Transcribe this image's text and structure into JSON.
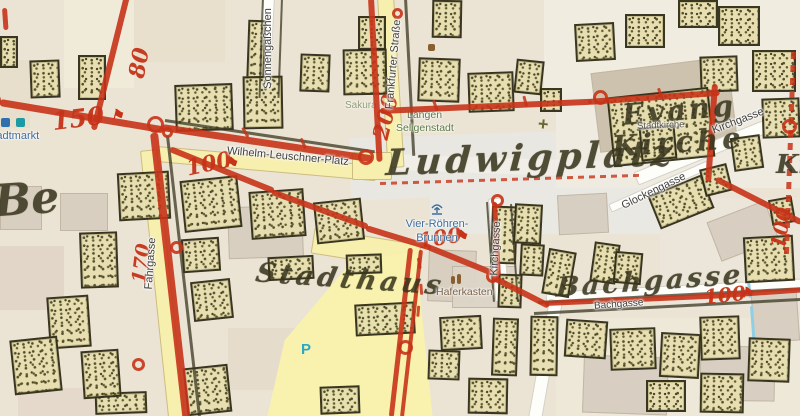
{
  "map": {
    "historic": {
      "square": "Ludwigplatz",
      "townhouse": "Stadthaus",
      "bach": "Bachgasse",
      "church1": "Evang",
      "church2": "Kirche",
      "frag_left": "Be",
      "frag_right": "Ki"
    },
    "survey": {
      "m150": "150",
      "m100_a": "100",
      "m100_b": "100",
      "m100_c": "100",
      "m100_d": "100",
      "m200": "200",
      "m80": "80",
      "m170": "170"
    },
    "streets": {
      "wilhelm_leuschner": "Wilhelm-Leuschner-Platz",
      "frankfurter": "Frankfurter Straße",
      "sonnengaesschen": "Sonnengäßchen",
      "fahrgasse": "Fahrgasse",
      "kirchgasse_south": "Kirchgasse",
      "kirchgasse_ne": "Kirchgasse",
      "glockengasse": "Glockengasse",
      "bachgasse": "Bachgasse"
    },
    "pois": {
      "fountain1": "Vier-Röhren-",
      "fountain2": "Brunnen",
      "market": "Stadtmarkt",
      "haferkasten": "Haferkasten",
      "stadtkirche": "Stadtkirche",
      "place1": "Langen",
      "place2": "Seligenstadt",
      "restaurant": "Sakura",
      "parking": "P"
    },
    "colors": {
      "survey_red": "#c63318",
      "road_yellow": "#f7efad",
      "water_blue": "#8ecfe6",
      "poi_blue": "#3e6e9e",
      "poi_green": "#5f7a45",
      "poi_brown": "#7a6046",
      "parking_blue": "#29a8c8"
    }
  }
}
